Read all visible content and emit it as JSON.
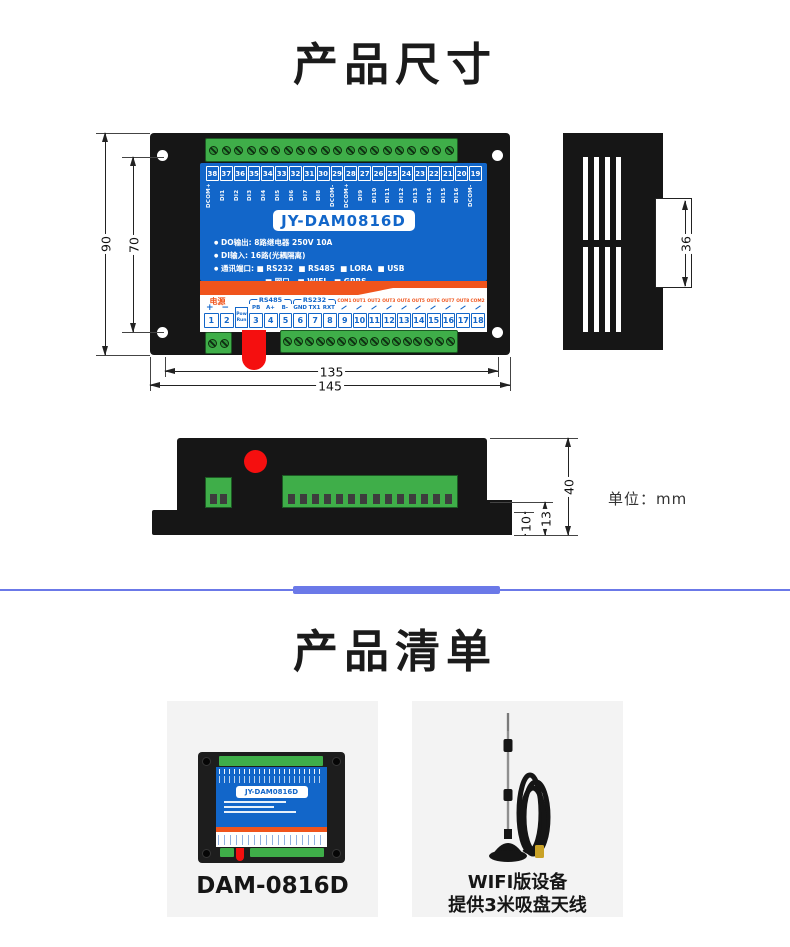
{
  "titles": {
    "section1": "产品尺寸",
    "section2": "产品清单"
  },
  "unit_note": "单位：mm",
  "colors": {
    "panel_blue": "#1266c9",
    "stripe_orange": "#f0541c",
    "terminal_green": "#3fae49",
    "button_red": "#f50f0f",
    "divider_blue": "#6b79e8",
    "body_black": "#161616"
  },
  "front_view": {
    "model": "JY-DAM0816D",
    "top_numbers": [
      "38",
      "37",
      "36",
      "35",
      "34",
      "33",
      "32",
      "31",
      "30",
      "29",
      "28",
      "27",
      "26",
      "25",
      "24",
      "23",
      "22",
      "21",
      "20",
      "19"
    ],
    "top_labels": [
      "DCOM+",
      "DI1",
      "DI2",
      "DI3",
      "DI4",
      "DI5",
      "DI6",
      "DI7",
      "DI8",
      "DCOM-",
      "DCOM+",
      "DI9",
      "DI10",
      "DI11",
      "DI12",
      "DI13",
      "DI14",
      "DI15",
      "DI16",
      "DCOM-"
    ],
    "specs": [
      {
        "b": "●",
        "t": "DO输出: 8路继电器 250V 10A"
      },
      {
        "b": "●",
        "t": "DI输入: 16路(光耦隔离)"
      },
      {
        "b": "●",
        "t": "通讯端口: ■ RS232  ■ RS485  ■ LORA  ■ USB"
      },
      {
        "b": "",
        "t": "■ 网口   ■ WIFI   ■ GPRS"
      }
    ],
    "bottom": {
      "power_label": "电源",
      "power_plus": "+",
      "power_minus": "−",
      "rs485_label": "RS485",
      "rs485_pins": [
        "PB",
        "A+",
        "B-"
      ],
      "rs232_label": "RS232",
      "rs232_pins": [
        "GND",
        "TX1",
        "RXT"
      ],
      "out_labels": [
        "COM1",
        "OUT1",
        "OUT2",
        "OUT3",
        "OUT4",
        "OUT5",
        "OUT6",
        "OUT7",
        "OUT8",
        "COM2"
      ],
      "numbers_left": [
        "1",
        "2"
      ],
      "pow": "Pow",
      "run": "Run",
      "numbers_right": [
        "3",
        "4",
        "5",
        "6",
        "7",
        "8",
        "9",
        "10",
        "11",
        "12",
        "13",
        "14",
        "15",
        "16",
        "17",
        "18"
      ]
    }
  },
  "dims": {
    "front_height_outer": "90",
    "front_height_inner": "70",
    "front_width_inner": "135",
    "front_width_outer": "145",
    "rail_clip": "36",
    "profile_height": "40",
    "profile_step": "13",
    "profile_foot": "10"
  },
  "products": [
    {
      "name": "DAM-0816D",
      "device_label": "JY-DAM0816D"
    },
    {
      "name_line1": "WIFI版设备",
      "name_line2": "提供3米吸盘天线"
    }
  ]
}
